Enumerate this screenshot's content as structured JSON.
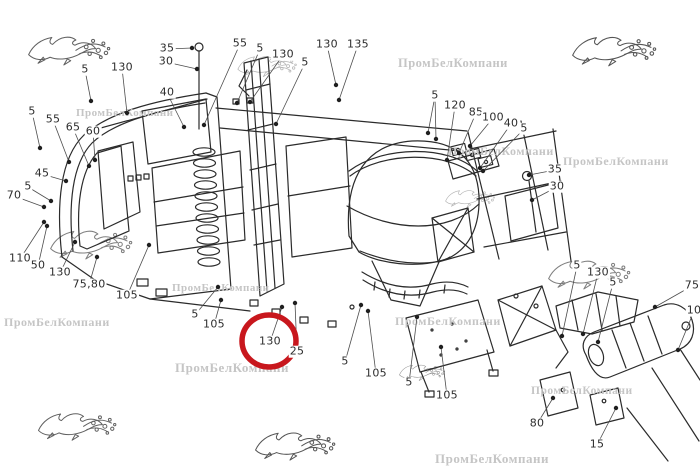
{
  "watermark": {
    "text": "ПромБелКомпани",
    "text_color": "#c5c5c5",
    "instances": [
      {
        "x": 76,
        "y": 108,
        "size": 11
      },
      {
        "x": 398,
        "y": 57,
        "size": 12.5
      },
      {
        "x": 448,
        "y": 145,
        "size": 12
      },
      {
        "x": 563,
        "y": 155,
        "size": 12
      },
      {
        "x": 172,
        "y": 283,
        "size": 11
      },
      {
        "x": 175,
        "y": 361,
        "size": 13
      },
      {
        "x": 4,
        "y": 316,
        "size": 12
      },
      {
        "x": 395,
        "y": 315,
        "size": 12
      },
      {
        "x": 531,
        "y": 386,
        "size": 11.5
      },
      {
        "x": 435,
        "y": 452,
        "size": 13
      }
    ],
    "logo": {
      "name": "leaping-gazelle",
      "body_color": "#a6a6a6",
      "accent_color": "#d98b8b",
      "instances": [
        {
          "x": 26,
          "y": 28,
          "w": 86,
          "o": 0.75
        },
        {
          "x": 570,
          "y": 28,
          "w": 88,
          "o": 0.8
        },
        {
          "x": 236,
          "y": 50,
          "w": 62,
          "o": 0.35
        },
        {
          "x": 48,
          "y": 222,
          "w": 86,
          "o": 0.6
        },
        {
          "x": 444,
          "y": 185,
          "w": 52,
          "o": 0.35
        },
        {
          "x": 546,
          "y": 252,
          "w": 86,
          "o": 0.6
        },
        {
          "x": 36,
          "y": 405,
          "w": 82,
          "o": 0.75
        },
        {
          "x": 253,
          "y": 424,
          "w": 84,
          "o": 0.8
        },
        {
          "x": 398,
          "y": 360,
          "w": 48,
          "o": 0.5
        }
      ]
    }
  },
  "diagram": {
    "highlight": {
      "shape": "ellipse",
      "cx": 269,
      "cy": 341,
      "rx": 27,
      "ry": 26,
      "color": "#c8171d",
      "stroke_width": 5.5,
      "circled_label": "130"
    },
    "callouts": [
      {
        "label": "35",
        "x": 167,
        "y": 49,
        "targets": [
          [
            192,
            48
          ]
        ]
      },
      {
        "label": "30",
        "x": 166,
        "y": 62,
        "targets": [
          [
            197,
            69
          ]
        ]
      },
      {
        "label": "5",
        "x": 85,
        "y": 70,
        "targets": [
          [
            91,
            101
          ]
        ]
      },
      {
        "label": "130",
        "x": 122,
        "y": 68,
        "targets": [
          [
            127,
            113
          ]
        ]
      },
      {
        "label": "40",
        "x": 167,
        "y": 93,
        "targets": [
          [
            184,
            127
          ]
        ]
      },
      {
        "label": "55",
        "x": 240,
        "y": 44,
        "targets": [
          [
            204,
            125
          ]
        ]
      },
      {
        "label": "5",
        "x": 260,
        "y": 49,
        "targets": [
          [
            237,
            103
          ]
        ]
      },
      {
        "label": "130",
        "x": 283,
        "y": 55,
        "targets": [
          [
            250,
            102
          ]
        ]
      },
      {
        "label": "5",
        "x": 305,
        "y": 63,
        "targets": [
          [
            276,
            124
          ]
        ]
      },
      {
        "label": "130",
        "x": 327,
        "y": 45,
        "targets": [
          [
            336,
            85
          ]
        ]
      },
      {
        "label": "135",
        "x": 358,
        "y": 45,
        "targets": [
          [
            339,
            100
          ]
        ]
      },
      {
        "label": "5",
        "x": 32,
        "y": 112,
        "targets": [
          [
            40,
            148
          ]
        ]
      },
      {
        "label": "55",
        "x": 53,
        "y": 120,
        "targets": [
          [
            69,
            162
          ]
        ]
      },
      {
        "label": "65",
        "x": 73,
        "y": 128,
        "targets": [
          [
            89,
            166
          ]
        ]
      },
      {
        "label": "60",
        "x": 93,
        "y": 132,
        "targets": [
          [
            95,
            160
          ]
        ]
      },
      {
        "label": "45",
        "x": 42,
        "y": 174,
        "targets": [
          [
            66,
            181
          ]
        ]
      },
      {
        "label": "5",
        "x": 28,
        "y": 187,
        "targets": [
          [
            51,
            201
          ]
        ]
      },
      {
        "label": "70",
        "x": 14,
        "y": 196,
        "targets": [
          [
            44,
            207
          ]
        ]
      },
      {
        "label": "110",
        "x": 20,
        "y": 259,
        "targets": [
          [
            44,
            222
          ]
        ]
      },
      {
        "label": "50",
        "x": 38,
        "y": 266,
        "targets": [
          [
            47,
            226
          ]
        ]
      },
      {
        "label": "130",
        "x": 60,
        "y": 273,
        "targets": [
          [
            75,
            242
          ]
        ]
      },
      {
        "label": "75,80",
        "x": 89,
        "y": 285,
        "targets": [
          [
            97,
            257
          ]
        ]
      },
      {
        "label": "105",
        "x": 127,
        "y": 296,
        "targets": [
          [
            149,
            245
          ]
        ]
      },
      {
        "label": "5",
        "x": 195,
        "y": 315,
        "targets": [
          [
            218,
            287
          ]
        ]
      },
      {
        "label": "105",
        "x": 214,
        "y": 325,
        "targets": [
          [
            221,
            300
          ]
        ]
      },
      {
        "label": "130",
        "x": 270,
        "y": 342,
        "targets": [
          [
            282,
            307
          ]
        ]
      },
      {
        "label": "25",
        "x": 297,
        "y": 352,
        "targets": [
          [
            295,
            303
          ]
        ]
      },
      {
        "label": "5",
        "x": 345,
        "y": 362,
        "targets": [
          [
            361,
            305
          ]
        ]
      },
      {
        "label": "105",
        "x": 376,
        "y": 374,
        "targets": [
          [
            368,
            311
          ]
        ]
      },
      {
        "label": "5",
        "x": 409,
        "y": 383,
        "targets": [
          [
            417,
            317
          ]
        ]
      },
      {
        "label": "105",
        "x": 447,
        "y": 396,
        "targets": [
          [
            441,
            347
          ]
        ]
      },
      {
        "label": "5",
        "x": 435,
        "y": 96,
        "targets": [
          [
            428,
            133
          ],
          [
            436,
            139
          ]
        ]
      },
      {
        "label": "120",
        "x": 455,
        "y": 106,
        "targets": [
          [
            447,
            160
          ]
        ]
      },
      {
        "label": "85",
        "x": 476,
        "y": 113,
        "targets": [
          [
            459,
            153
          ]
        ]
      },
      {
        "label": "100",
        "x": 493,
        "y": 118,
        "targets": [
          [
            470,
            146
          ]
        ]
      },
      {
        "label": "40",
        "x": 511,
        "y": 124,
        "targets": [
          [
            480,
            168
          ]
        ]
      },
      {
        "label": "5",
        "x": 524,
        "y": 129,
        "targets": [
          [
            483,
            171
          ]
        ]
      },
      {
        "label": "35",
        "x": 555,
        "y": 170,
        "targets": [
          [
            529,
            175
          ]
        ]
      },
      {
        "label": "30",
        "x": 557,
        "y": 187,
        "targets": [
          [
            532,
            200
          ]
        ]
      },
      {
        "label": "5",
        "x": 577,
        "y": 266,
        "targets": [
          [
            562,
            336
          ]
        ]
      },
      {
        "label": "130",
        "x": 598,
        "y": 273,
        "targets": [
          [
            583,
            334
          ]
        ]
      },
      {
        "label": "5",
        "x": 613,
        "y": 283,
        "targets": [
          [
            598,
            342
          ]
        ]
      },
      {
        "label": "75",
        "x": 692,
        "y": 286,
        "targets": [
          [
            655,
            307
          ]
        ]
      },
      {
        "label": "10",
        "x": 694,
        "y": 311,
        "targets": [
          [
            678,
            350
          ]
        ]
      },
      {
        "label": "80",
        "x": 537,
        "y": 424,
        "targets": [
          [
            553,
            398
          ]
        ]
      },
      {
        "label": "15",
        "x": 597,
        "y": 445,
        "targets": [
          [
            616,
            408
          ]
        ]
      }
    ]
  }
}
